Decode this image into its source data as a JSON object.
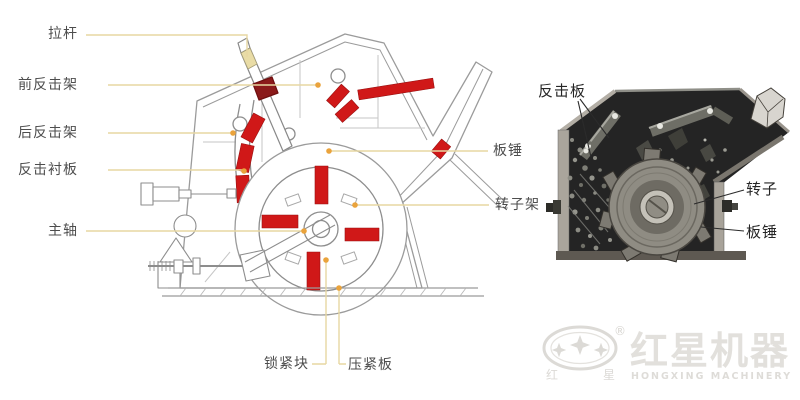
{
  "left_diagram": {
    "labels": {
      "tie_rod": "拉杆",
      "front_impact_frame": "前反击架",
      "rear_impact_frame": "后反击架",
      "impact_liner": "反击衬板",
      "main_shaft": "主轴",
      "lock_block": "锁紧块",
      "pressing_plate": "压紧板",
      "blow_bar": "板锤",
      "rotor_frame": "转子架"
    }
  },
  "right_photo": {
    "labels": {
      "impact_plate": "反击板",
      "rotor": "转子",
      "blow_bar": "板锤"
    }
  },
  "logo": {
    "cn_small_left": "红",
    "cn_small_right": "星",
    "registered_mark": "®",
    "brand_cn": "红星机器",
    "brand_en": "HONGXING MACHINERY"
  },
  "colors": {
    "highlight_red": "#d01818",
    "dark_red": "#8b1a1a",
    "leader_line": "#e7d7a2",
    "leader_dot": "#eaa33c",
    "label_text": "#4d4d4d",
    "photo_background": "#242424"
  }
}
